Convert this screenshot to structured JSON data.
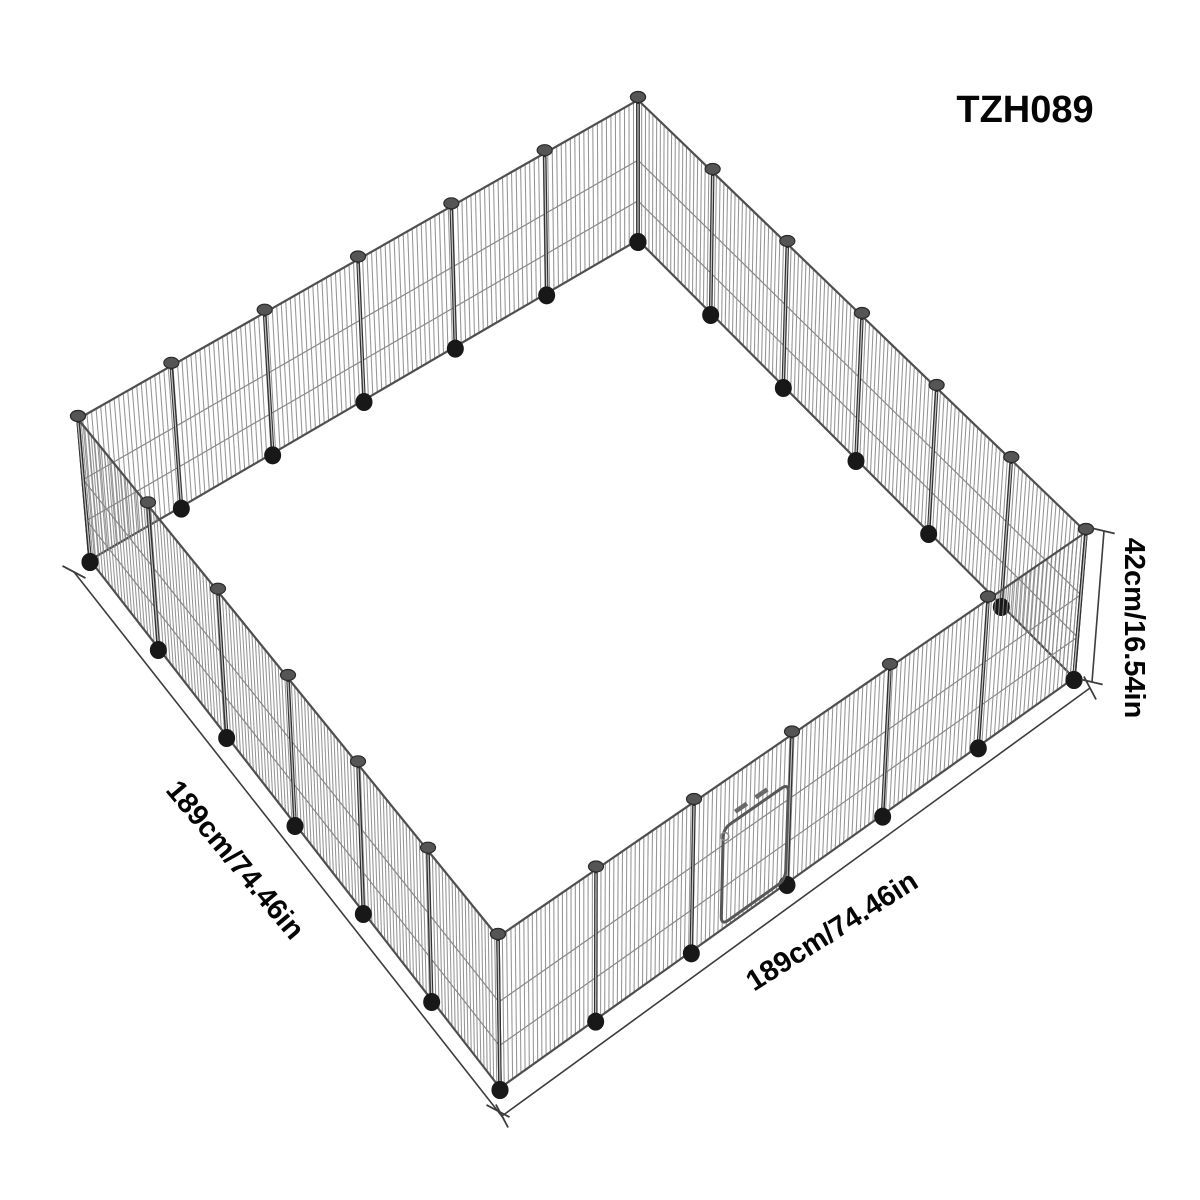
{
  "product": {
    "model_code": "TZH089",
    "dimensions": {
      "height": "42cm/16.54in",
      "side_left": "189cm/74.46in",
      "side_right": "189cm/74.46in"
    }
  },
  "diagram": {
    "description": "Isometric line drawing of a square wire pet playpen with a small gate on the front-right wall",
    "sides": 4,
    "panels_per_side": 6
  },
  "colors": {
    "background": "#ffffff",
    "text": "#050505",
    "wire": "#888888",
    "rail": "#4f4f4f",
    "post": "#303030",
    "post_highlight": "#c4c4c4",
    "cap": "#555555",
    "cap_rim": "#2a2a2a",
    "foot": "#181818",
    "dimension_line": "#3d3d3d",
    "door": "#585858"
  }
}
